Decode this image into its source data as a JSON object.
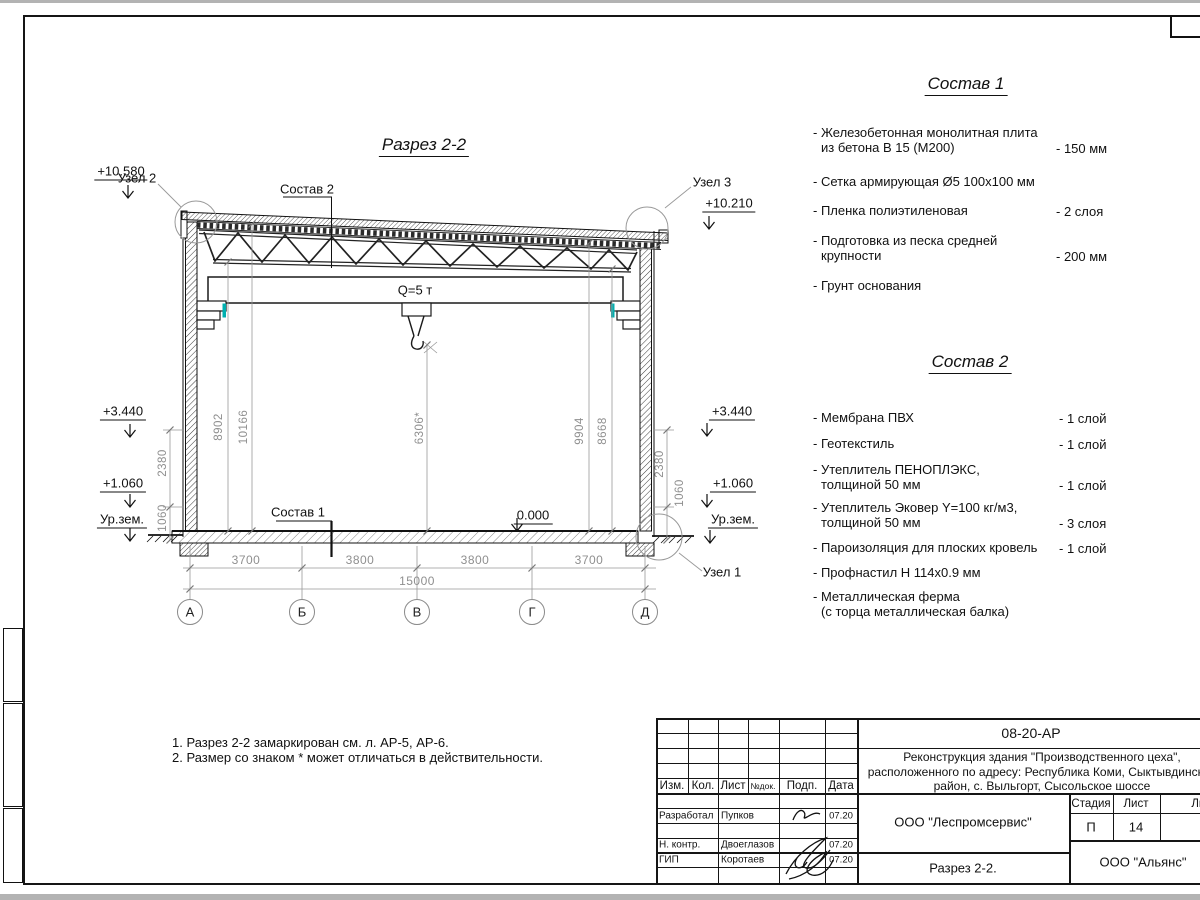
{
  "colors": {
    "line": "#1a1a1a",
    "dim_gray": "#8f8f8f",
    "accent_cyan": "#00b0b0"
  },
  "drawing": {
    "title": "Разрез 2-2",
    "crane": "Q=5 т",
    "callouts": {
      "uzel1": "Узел 1",
      "uzel2": "Узел 2",
      "uzel3": "Узел 3",
      "sostav1": "Состав 1",
      "sostav2": "Состав 2"
    },
    "elev": {
      "l1": "+10.580",
      "l2": "+3.440",
      "l3": "+1.060",
      "l4": "Ур.зем.",
      "r1": "+10.210",
      "r2": "+3.440",
      "r3": "+1.060",
      "r4": "Ур.зем.",
      "zero": "0.000"
    },
    "dims": {
      "h_left_a": "8902",
      "h_left_b": "10166",
      "h_right_a": "9904",
      "h_right_b": "8668",
      "center": "6306*",
      "lo_a": "2380",
      "lo_b": "1060",
      "ro_a": "2380",
      "ro_b": "1060",
      "b1": "3700",
      "b2": "3800",
      "b3": "3800",
      "b4": "3700",
      "total": "15000"
    },
    "axes": [
      "А",
      "Б",
      "В",
      "Г",
      "Д"
    ]
  },
  "sostav1": {
    "title": "Состав 1",
    "items": [
      {
        "line1": "- Железобетонная монолитная плита",
        "line2": "из бетона В 15 (М200)",
        "value": "- 150 мм"
      },
      {
        "line1": "- Сетка армирующая Ø5 100х100 мм",
        "line2": "",
        "value": ""
      },
      {
        "line1": "- Пленка полиэтиленовая",
        "line2": "",
        "value": "- 2 слоя"
      },
      {
        "line1": "- Подготовка из песка средней",
        "line2": "крупности",
        "value": "- 200 мм"
      },
      {
        "line1": "- Грунт основания",
        "line2": "",
        "value": ""
      }
    ]
  },
  "sostav2": {
    "title": "Состав 2",
    "items": [
      {
        "line1": "- Мембрана ПВХ",
        "line2": "",
        "value": "- 1 слой"
      },
      {
        "line1": "- Геотекстиль",
        "line2": "",
        "value": "- 1 слой"
      },
      {
        "line1": "- Утеплитель ПЕНОПЛЭКС,",
        "line2": "толщиной 50 мм",
        "value": "- 1 слой"
      },
      {
        "line1": "- Утеплитель Эковер Y=100 кг/м3,",
        "line2": "толщиной 50 мм",
        "value": "- 3 слоя"
      },
      {
        "line1": "- Пароизоляция для плоских кровель",
        "line2": "",
        "value": "- 1 слой"
      },
      {
        "line1": "- Профнастил Н 114х0.9 мм",
        "line2": "",
        "value": ""
      },
      {
        "line1": "- Металлическая ферма",
        "line2": "(с торца металлическая балка)",
        "value": ""
      }
    ]
  },
  "notes": {
    "n1": "1. Разрез 2-2 замаркирован см. л. АР-5, АР-6.",
    "n2": "2. Размер со знаком * может отличаться в действительности."
  },
  "titleblock": {
    "doc": "08-20-АР",
    "project": {
      "line1": "Реконструкция здания \"Производственного цеха\",",
      "line2": "расположенного по адресу: Республика Коми, Сыктывдинский",
      "line3": "район, с. Выльгорт, Сысольское шоссе"
    },
    "cols": {
      "izm": "Изм.",
      "kol": "Кол.",
      "list": "Лист",
      "ndok": "№док.",
      "podp": "Подп.",
      "data": "Дата"
    },
    "rows": [
      {
        "role": "Разработал",
        "name": "Пупков",
        "date": "07.20"
      },
      {
        "role": "Н. контр.",
        "name": "Двоеглазов",
        "date": "07.20"
      },
      {
        "role": "ГИП",
        "name": "Коротаев",
        "date": "07.20"
      }
    ],
    "org1": "ООО \"Леспромсервис\"",
    "stage_h": "Стадия",
    "list_h": "Лист",
    "listov_h": "Листов",
    "stage": "П",
    "list_num": "14",
    "title": "Разрез 2-2.",
    "org2": "ООО \"Альянс\""
  }
}
